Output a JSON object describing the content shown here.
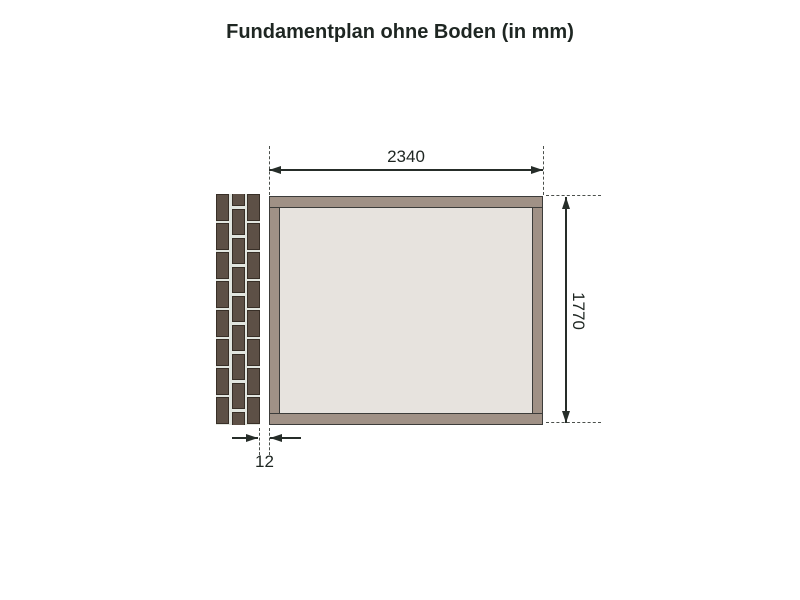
{
  "title": "Fundamentplan ohne Boden (in mm)",
  "dimensions": {
    "width_mm": "2340",
    "height_mm": "1770",
    "gap_mm": "12"
  },
  "diagram": {
    "type": "foundation-plan",
    "foundation_outer_width_mm": 2340,
    "foundation_outer_depth_mm": 1770,
    "gap_wall_to_foundation_mm": 12,
    "elements": [
      "brick-wall",
      "foundation-frame",
      "dimension-lines"
    ]
  },
  "colors": {
    "line": "#262d29",
    "line_dash": "#4b504c",
    "text": "#1e2622",
    "frame_fill": "#a09186",
    "frame_line": "#3c3c3a",
    "interior_fill": "#e7e3de",
    "brick_fill": "#5d5046",
    "brick_border": "#382f27",
    "mortar": "#e2e6e0",
    "bg": "#ffffff"
  },
  "brick_wall": {
    "pattern": "stretcher-bond",
    "columns": [
      {
        "offset": false
      },
      {
        "offset": true
      },
      {
        "offset": false
      }
    ],
    "col_width": 13,
    "col_gap": 2.5,
    "period": 29,
    "row_gap": 2.5,
    "height": 231
  }
}
